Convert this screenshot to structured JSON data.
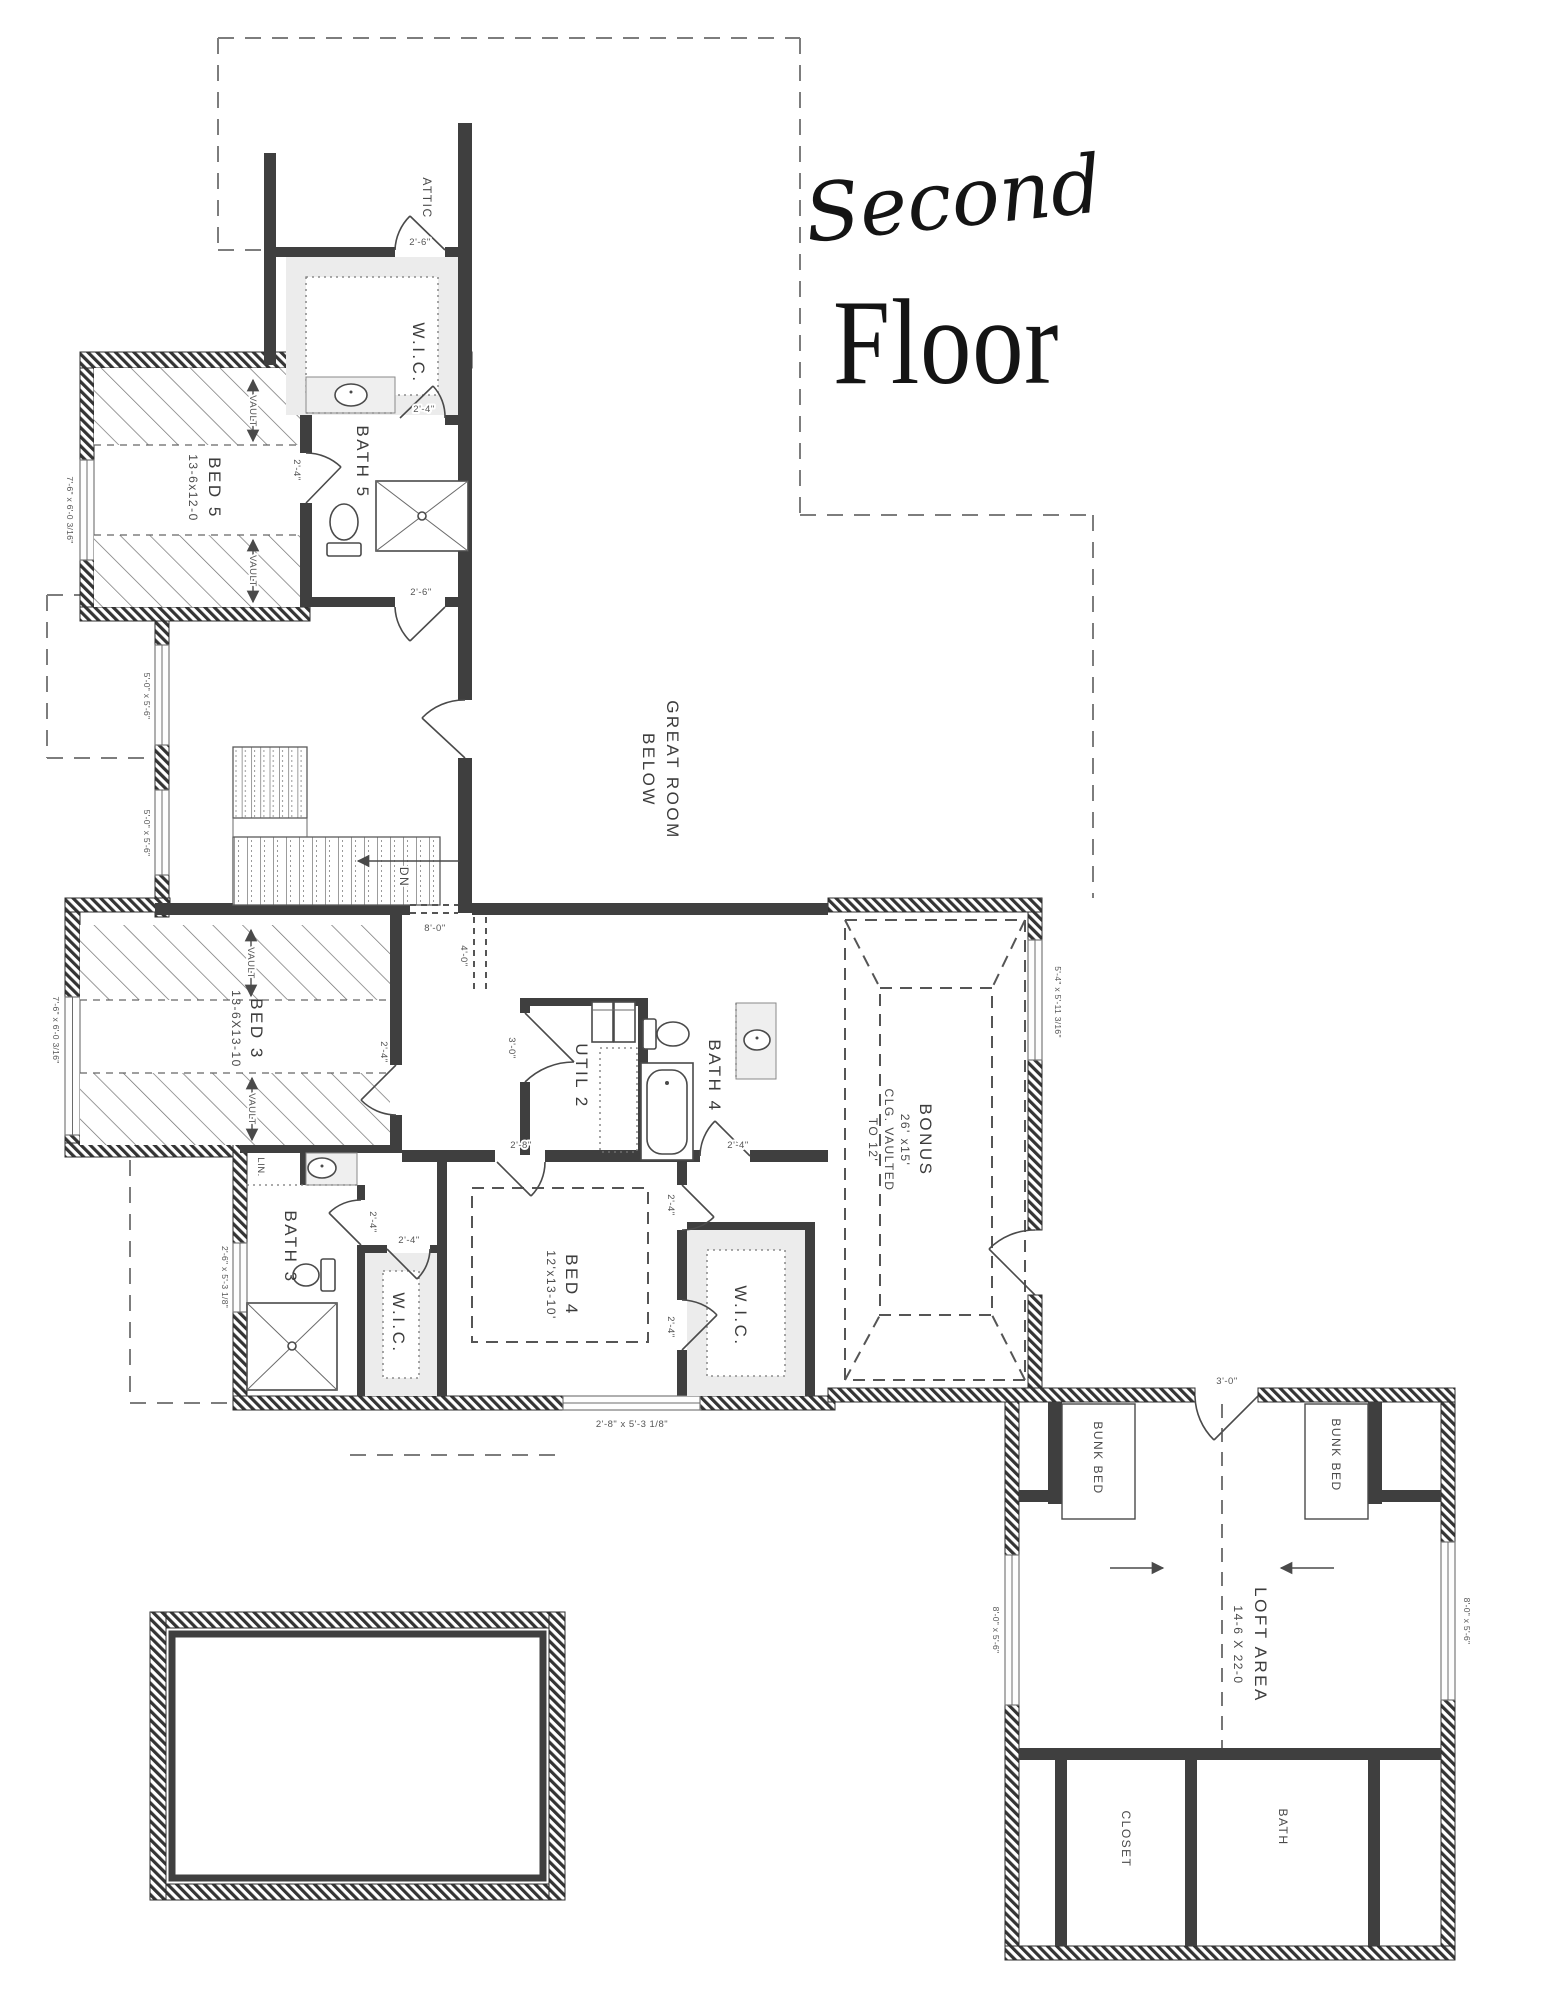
{
  "title": {
    "script": "Second",
    "main": "Floor"
  },
  "rooms": {
    "attic": {
      "name": "ATTIC"
    },
    "wic_top": {
      "name": "W.I.C."
    },
    "bath5": {
      "name": "BATH 5"
    },
    "bed5": {
      "name": "BED 5",
      "size": "13-6x12-0"
    },
    "great_room": {
      "name": "GREAT ROOM",
      "name2": "BELOW"
    },
    "bed3": {
      "name": "BED 3",
      "size": "13-6X13-10"
    },
    "util2": {
      "name": "UTIL 2"
    },
    "bath4": {
      "name": "BATH 4"
    },
    "bonus": {
      "name": "BONUS",
      "size": "26' x15'",
      "note1": "CLG. VAULTED",
      "note2": "TO 12'"
    },
    "bed4": {
      "name": "BED 4",
      "size": "12'x13-10'"
    },
    "wic_left": {
      "name": "W.I.C."
    },
    "wic_right": {
      "name": "W.I.C."
    },
    "bath3": {
      "name": "BATH 3"
    },
    "lin": {
      "name": "LIN."
    },
    "loft": {
      "name": "LOFT AREA",
      "size": "14-6 X 22-0"
    },
    "bunk_left": {
      "name": "BUNK BED"
    },
    "bunk_right": {
      "name": "BUNK BED"
    },
    "closet": {
      "name": "CLOSET"
    },
    "bath_loft": {
      "name": "BATH"
    }
  },
  "annotations": {
    "vault": "VAULT",
    "down": "DN"
  },
  "dims": {
    "attic_door": "2'-6\"",
    "wic_top_door": "2'-4\"",
    "bath5_door": "2'-4\"",
    "hall_top_door": "2'-6\"",
    "bed5_window": "7'-6\" x 6'-0 3/16\"",
    "stair_window_upper": "5'-0\" x 5'-6\"",
    "stair_window_lower": "5'-0\" x 5'-6\"",
    "stair_opening": "8'-0\"",
    "hall_opening": "4'-0\"",
    "bed3_window": "7'-6\" x 6'-0 3/16\"",
    "bed3_door": "2'-4\"",
    "util2_door": "3'-0\"",
    "bed4_door": "2'-8\"",
    "bath4_door": "2'-4\"",
    "bath3_door": "2'-4\"",
    "wic_left_door": "2'-4\"",
    "wic_right_door_top": "2'-4\"",
    "wic_right_door": "2'-4\"",
    "bath3_window": "2'-6\" x 5'-3 1/8\"",
    "bed4_window": "2'-8\" x 5'-3 1/8\"",
    "bonus_window": "5'-4\" x 5'-11 3/16\"",
    "loft_door": "3'-0\"",
    "loft_window_left": "8'-0\" x 5'-6\"",
    "loft_window_right": "8'-0\" x 5'-6\""
  }
}
